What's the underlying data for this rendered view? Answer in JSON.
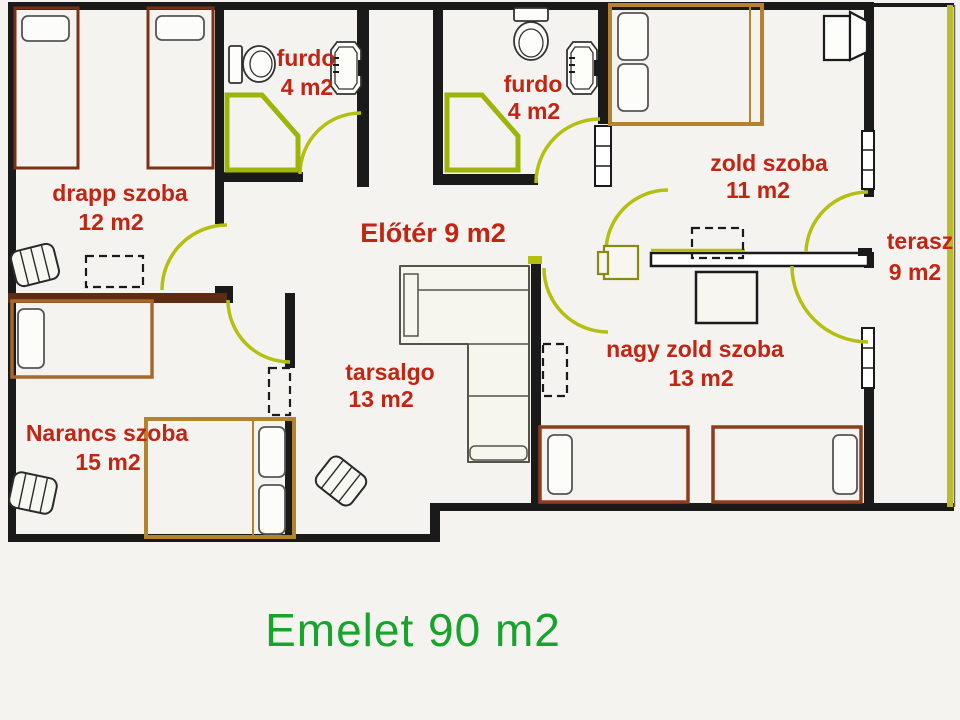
{
  "title": {
    "text": "Emelet  90 m2"
  },
  "rooms": {
    "drapp": {
      "name": "drapp szoba",
      "area": "12 m2"
    },
    "furdo_left": {
      "name": "furdo",
      "area": "4 m2"
    },
    "furdo_right": {
      "name": "furdo",
      "area": "4 m2"
    },
    "eloter": {
      "name": "Előtér 9 m2"
    },
    "zold": {
      "name": "zold szoba",
      "area": "11 m2"
    },
    "terasz": {
      "name": "terasz",
      "area": "9 m2"
    },
    "tarsalgo": {
      "name": "tarsalgo",
      "area": "13 m2"
    },
    "nagy_zold": {
      "name": "nagy zold szoba",
      "area": "13 m2"
    },
    "narancs": {
      "name": "Narancs szoba",
      "area": "15 m2"
    }
  },
  "colors": {
    "label_red": "#c22513",
    "title_green": "#16a42c",
    "wall_black": "#1a1a1a",
    "door_olive": "#b4c010",
    "shower_olive": "#9eb408",
    "terasz_olive": "#bcbc28",
    "bed_tan": "#b5832e",
    "bed_maroon": "#7c3014",
    "bed_brick": "#8e3c1e",
    "bed_light_brown": "#a8682a",
    "narancs_wall_brown": "#5c2d12",
    "background": "#f4f3ef"
  }
}
